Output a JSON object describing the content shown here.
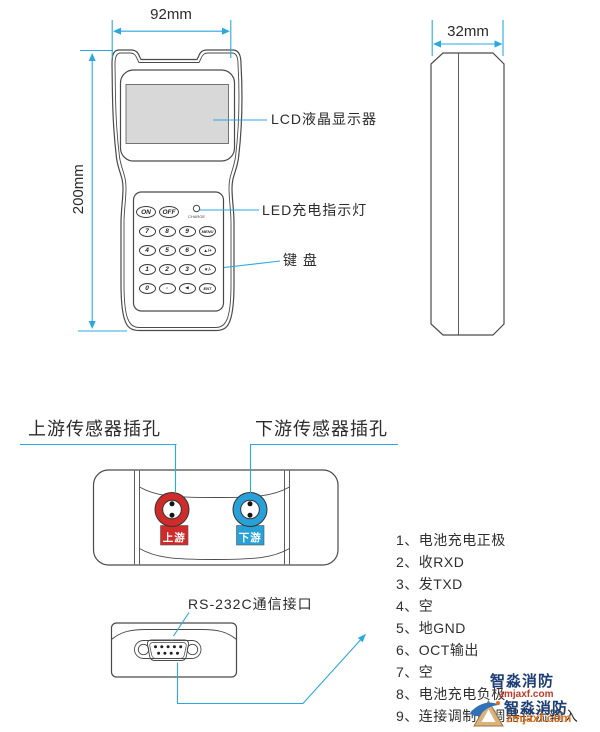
{
  "front_view": {
    "width_label": "92mm",
    "height_label": "200mm",
    "lcd_label": "LCD液晶显示器",
    "led_label": "LED充电指示灯",
    "keypad_label": "键 盘",
    "charge_label": "CHARGE",
    "keys": {
      "on": "ON",
      "off": "OFF",
      "grid": [
        "7",
        "8",
        "9",
        "MENU",
        "4",
        "5",
        "6",
        "▲/+",
        "1",
        "2",
        "3",
        "▼/-",
        "0",
        "·",
        "◀",
        "ENT"
      ]
    }
  },
  "side_view": {
    "width_label": "32mm"
  },
  "bottom_view": {
    "upstream_label": "上游传感器插孔",
    "downstream_label": "下游传感器插孔",
    "upstream_tag": "上游",
    "downstream_tag": "下游",
    "red": "#cf2b2b",
    "blue": "#28a0d8"
  },
  "rs232": {
    "title": "RS-232C通信接口",
    "pins": [
      "1、电池充电正极",
      "2、收RXD",
      "3、发TXD",
      "4、空",
      "5、地GND",
      "6、OCT输出",
      "7、空",
      "8、电池充电负极",
      "9、连接调制解调器铃流输入"
    ]
  },
  "watermark": {
    "name1": "智淼消防",
    "url1": "zmjaxf.com",
    "name2": "智淼消防",
    "url2": "zmjaxf.com"
  },
  "colors": {
    "accent": "#2aa9e0",
    "line": "#4a4a4a",
    "lcd_fill": "#d8d8d8"
  }
}
